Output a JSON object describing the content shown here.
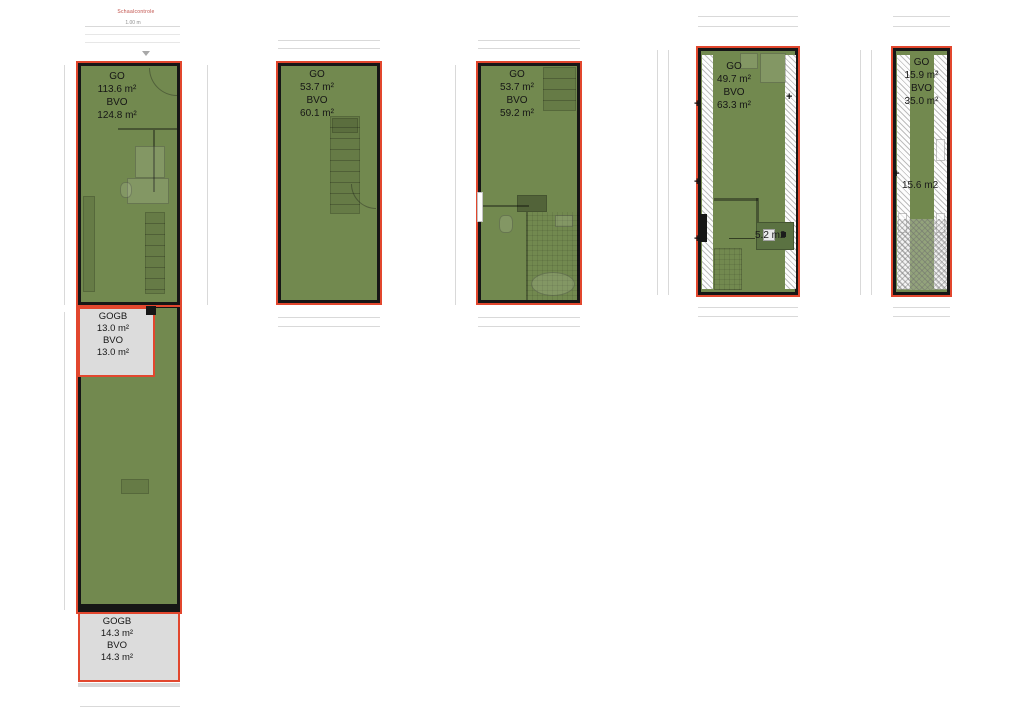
{
  "scale": {
    "title": "Schaalcontrole",
    "length": "1.00 m"
  },
  "plans": [
    {
      "go": "GO",
      "go_value": "113.6 m²",
      "bvo": "BVO",
      "bvo_value": "124.8 m²"
    },
    {
      "go": "GO",
      "go_value": "53.7 m²",
      "bvo": "BVO",
      "bvo_value": "60.1 m²"
    },
    {
      "go": "GO",
      "go_value": "53.7 m²",
      "bvo": "BVO",
      "bvo_value": "59.2 m²"
    },
    {
      "go": "GO",
      "go_value": "49.7 m²",
      "bvo": "BVO",
      "bvo_value": "63.3 m²",
      "annotation": "5.2 m2"
    },
    {
      "go": "GO",
      "go_value": "15.9 m²",
      "bvo": "BVO",
      "bvo_value": "35.0 m²",
      "annotation": "15.6 m2"
    }
  ],
  "gogb": [
    {
      "label": "GOGB",
      "value": "13.0 m²",
      "bvo": "BVO",
      "bvo_value": "13.0 m²"
    },
    {
      "label": "GOGB",
      "value": "14.3 m²",
      "bvo": "BVO",
      "bvo_value": "14.3 m²"
    }
  ],
  "colors": {
    "floor_green": "#72894f",
    "gogb_grey": "#dcdcdc",
    "border_red": "#e2472e",
    "wall_black": "#161616",
    "hatch_line": "#bdbdbd",
    "dim_line": "#d9d9d9",
    "scale_red": "#bf4b45",
    "annotation_text": "#1a1a1a"
  }
}
